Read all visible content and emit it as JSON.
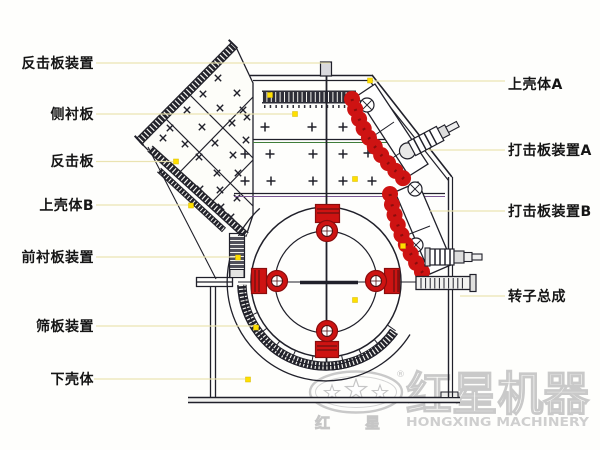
{
  "callouts": {
    "left": [
      {
        "label": "反击板装置"
      },
      {
        "label": "侧衬板"
      },
      {
        "label": "反击板"
      },
      {
        "label": "上壳体B"
      },
      {
        "label": "前衬板装置"
      },
      {
        "label": "筛板装置"
      },
      {
        "label": "下壳体"
      }
    ],
    "right": [
      {
        "label": "上壳体A"
      },
      {
        "label": "打击板装置A"
      },
      {
        "label": "打击板装置B"
      },
      {
        "label": "转子总成"
      }
    ]
  },
  "watermark": {
    "brand_cn": "红星机器",
    "brand_en": "HONGXING MACHINERY",
    "char_left": "红",
    "char_right": "星",
    "registered_mark": "®"
  },
  "colors": {
    "line_dark": "#20202a",
    "highlight_red": "#ce1312",
    "leader_yellow": "#e9e2ae",
    "dot_yellow": "#ffdf00",
    "watermark_gray": "#c9c9c9"
  }
}
